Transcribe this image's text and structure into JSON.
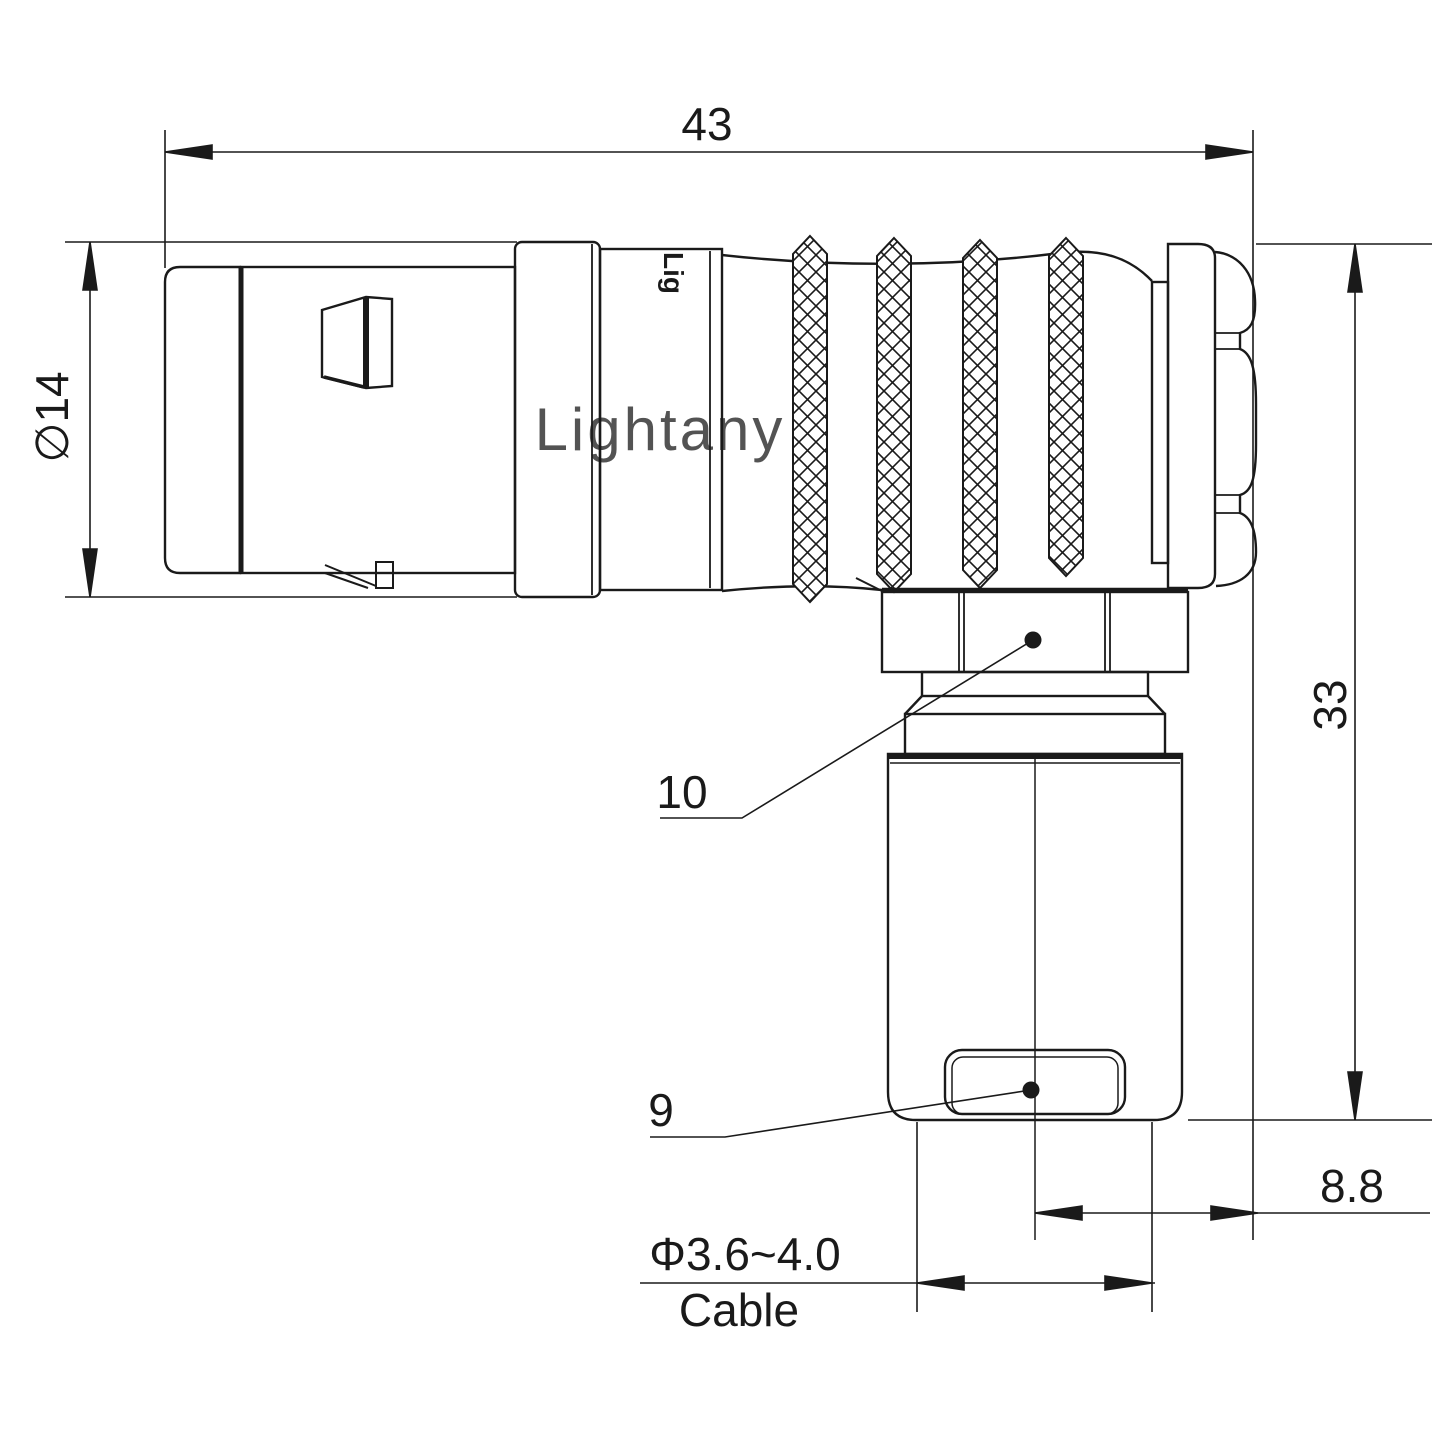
{
  "drawing": {
    "kind": "connector-engineering-drawing",
    "watermark": "Lightany",
    "body_logo_text": "Lig",
    "labels": {
      "overall_length": "43",
      "front_diameter": "∅14",
      "overall_height": "33",
      "axis_offset": "8.8",
      "cable_diameter_range": "Φ3.6~4.0",
      "cable_word": "Cable",
      "coupling_nut_ref": "10",
      "cable_clamp_ref": "9"
    },
    "colors": {
      "line": "#1a1a1a",
      "watermark": "#f0b9b9",
      "background": "#ffffff"
    }
  }
}
